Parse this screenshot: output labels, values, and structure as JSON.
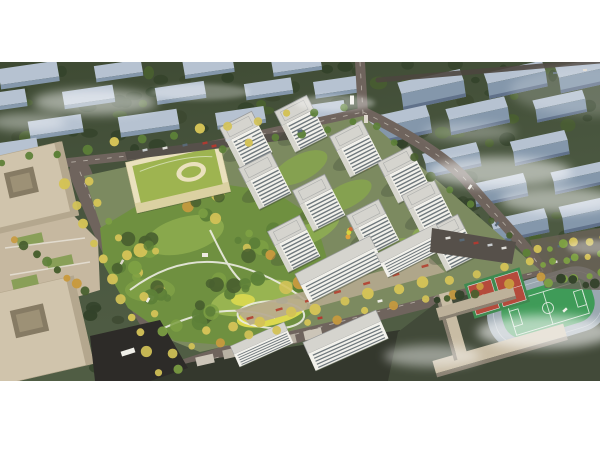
{
  "page": {
    "background": "#ffffff"
  },
  "frame": {
    "x": 0,
    "y": 62,
    "width": 600,
    "height": 319
  },
  "scene": {
    "kind": "aerial-architectural-rendering",
    "elements": [
      "context-housing-blocks",
      "forest-trees",
      "fog-clouds",
      "perimeter-roads",
      "residential-towers",
      "central-park",
      "kindergarten",
      "commercial-street",
      "office-buildings",
      "school-campus",
      "sports-field",
      "basketball-courts",
      "tree-lined-boulevards",
      "parking-lots",
      "vehicles"
    ]
  },
  "palette": {
    "paper": "#ffffff",
    "forest": "#46523a",
    "forestDark": "#3a462e",
    "treeDark": "#33422a",
    "treeMid": "#49602f",
    "treeGreen": "#5d8038",
    "treeLight": "#7da043",
    "treeYellow": "#d3c257",
    "treeOrange": "#c89a3e",
    "slabRoof": "#b6c2d1",
    "slabSide": "#8497ab",
    "slabDark": "#60718a",
    "road": "#6f645d",
    "roadDark": "#4c463f",
    "asphalt": "#2d2b28",
    "roadLine": "#ded8cd",
    "devGround": "#7c8a60",
    "paveLight": "#b5a88f",
    "paveTan": "#c6b8a0",
    "parkGreen": "#6f9040",
    "parkLight": "#94b251",
    "lawnYellow": "#dcd94f",
    "pathWhite": "#edece4",
    "towerFace": "#f2f1eb",
    "towerSide": "#d7d6ce",
    "towerWin": "#59646a",
    "towerRoof": "#d5d4ce",
    "roofEdge": "#9a9c9d",
    "kgRoof": "#9eb450",
    "kgFace": "#eae1bd",
    "officeRoof": "#d0c4ac",
    "officeFace": "#b4a78e",
    "officeDark": "#867b64",
    "schoolRoof": "#c8bca4",
    "schoolSide": "#8a8172",
    "groundDark": "#424a39",
    "lotDark": "#56504a",
    "fieldGreen": "#3f9b58",
    "track": "#9aa7b0",
    "trackLine": "#c9d0d6",
    "courtRed": "#b44b3c",
    "courtGreen": "#3f8a50",
    "shadow": "#3c4734",
    "cloud": "#ffffff",
    "awningRed": "#b3402f",
    "pondBlue": "#7ab3c0",
    "busWhite": "#f0efe8",
    "carRed": "#b23a30",
    "carGray": "#5a6a78"
  }
}
